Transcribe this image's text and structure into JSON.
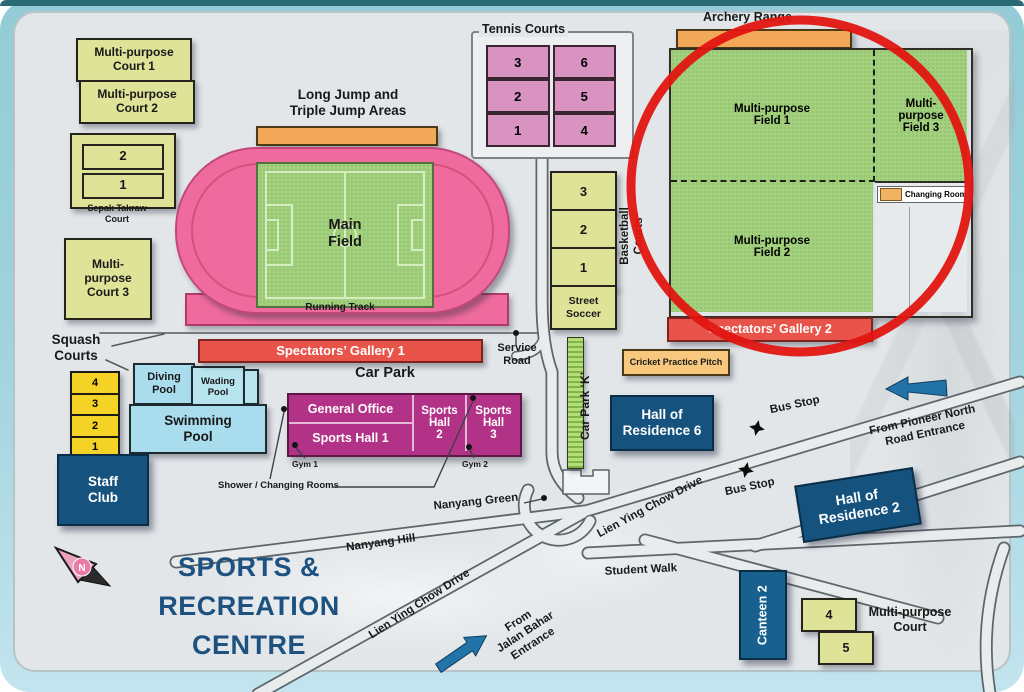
{
  "title": {
    "line1": "SPORTS &",
    "line2": "RECREATION",
    "line3": "CENTRE"
  },
  "compass": {
    "letter": "N"
  },
  "colors": {
    "frame_teal": "#93cbd6",
    "map_bg": "#e2e6e9",
    "court_yellow_green": "#dfe398",
    "field_green": "#a3d07e",
    "track_pink": "#ef6b9d",
    "tennis_pink": "#d893c0",
    "gallery_red": "#e8544a",
    "hall_magenta": "#b13287",
    "building_blue": "#15537e",
    "pool_blue": "#a9dcec",
    "squash_yellow": "#f4d326",
    "bar_orange": "#f2a859",
    "highlight_circle_red": "#e21511",
    "title_blue": "#1d5180",
    "arrow_blue": "#2273a8"
  },
  "mp_courts": {
    "c1": "Multi-purpose\nCourt 1",
    "c2": "Multi-purpose\nCourt 2",
    "c3": "Multi-\npurpose\nCourt 3"
  },
  "sepak": {
    "label": "Sepak Takraw\nCourt",
    "cells": [
      "2",
      "1"
    ]
  },
  "long_jump": {
    "label": "Long Jump and\nTriple Jump Areas"
  },
  "track": {
    "field_label": "Main\nField",
    "track_label": "Running Track"
  },
  "tennis": {
    "label": "Tennis Courts",
    "cells": [
      "3",
      "6",
      "2",
      "5",
      "1",
      "4"
    ]
  },
  "archery": {
    "label": "Archery Range"
  },
  "fields": {
    "f1": "Multi-purpose\nField 1",
    "f3": "Multi-\npurpose\nField 3",
    "f2": "Multi-purpose\nField 2",
    "changing_room": "Changing Room"
  },
  "galleries": {
    "g1": "Spectators’ Gallery 1",
    "g2": "Spectators’ Gallery 2"
  },
  "cricket": {
    "label": "Cricket Practice Pitch"
  },
  "basketball": {
    "label": "Basketball\nCourts",
    "cells": [
      "3",
      "2",
      "1"
    ],
    "street_soccer": "Street\nSoccer"
  },
  "squash": {
    "label": "Squash\nCourts",
    "cells": [
      "4",
      "3",
      "2",
      "1"
    ]
  },
  "pools": {
    "diving": "Diving\nPool",
    "wading": "Wading\nPool",
    "swimming": "Swimming\nPool"
  },
  "staff_club": {
    "label": "Staff\nClub"
  },
  "car_park": {
    "label": "Car Park",
    "k_label": "Car Park ‘K’"
  },
  "halls": {
    "general_office": "General Office",
    "hall1": "Sports Hall 1",
    "hall2": "Sports\nHall\n2",
    "hall3": "Sports\nHall\n3",
    "gym1": "Gym 1",
    "gym2": "Gym 2",
    "shower": "Shower / Changing Rooms"
  },
  "service_road": {
    "label": "Service\nRoad"
  },
  "residences": {
    "r6": "Hall of\nResidence 6",
    "r2": "Hall of\nResidence 2"
  },
  "bus_stops": {
    "b1": "Bus Stop",
    "b2": "Bus Stop"
  },
  "entrances": {
    "pioneer": "From Pioneer North\nRoad Entrance",
    "jalan": "From\nJalan Bahar\nEntrance"
  },
  "roads": {
    "nanyang_green": "Nanyang Green",
    "nanyang_hill": "Nanyang Hill",
    "lien_sw": "Lien Ying Chow Drive",
    "lien_ne": "Lien Ying Chow Drive",
    "student_walk": "Student Walk"
  },
  "canteen": {
    "label": "Canteen 2"
  },
  "mp_court_br": {
    "label": "Multi-purpose\nCourt",
    "cells": [
      "4",
      "5"
    ]
  }
}
